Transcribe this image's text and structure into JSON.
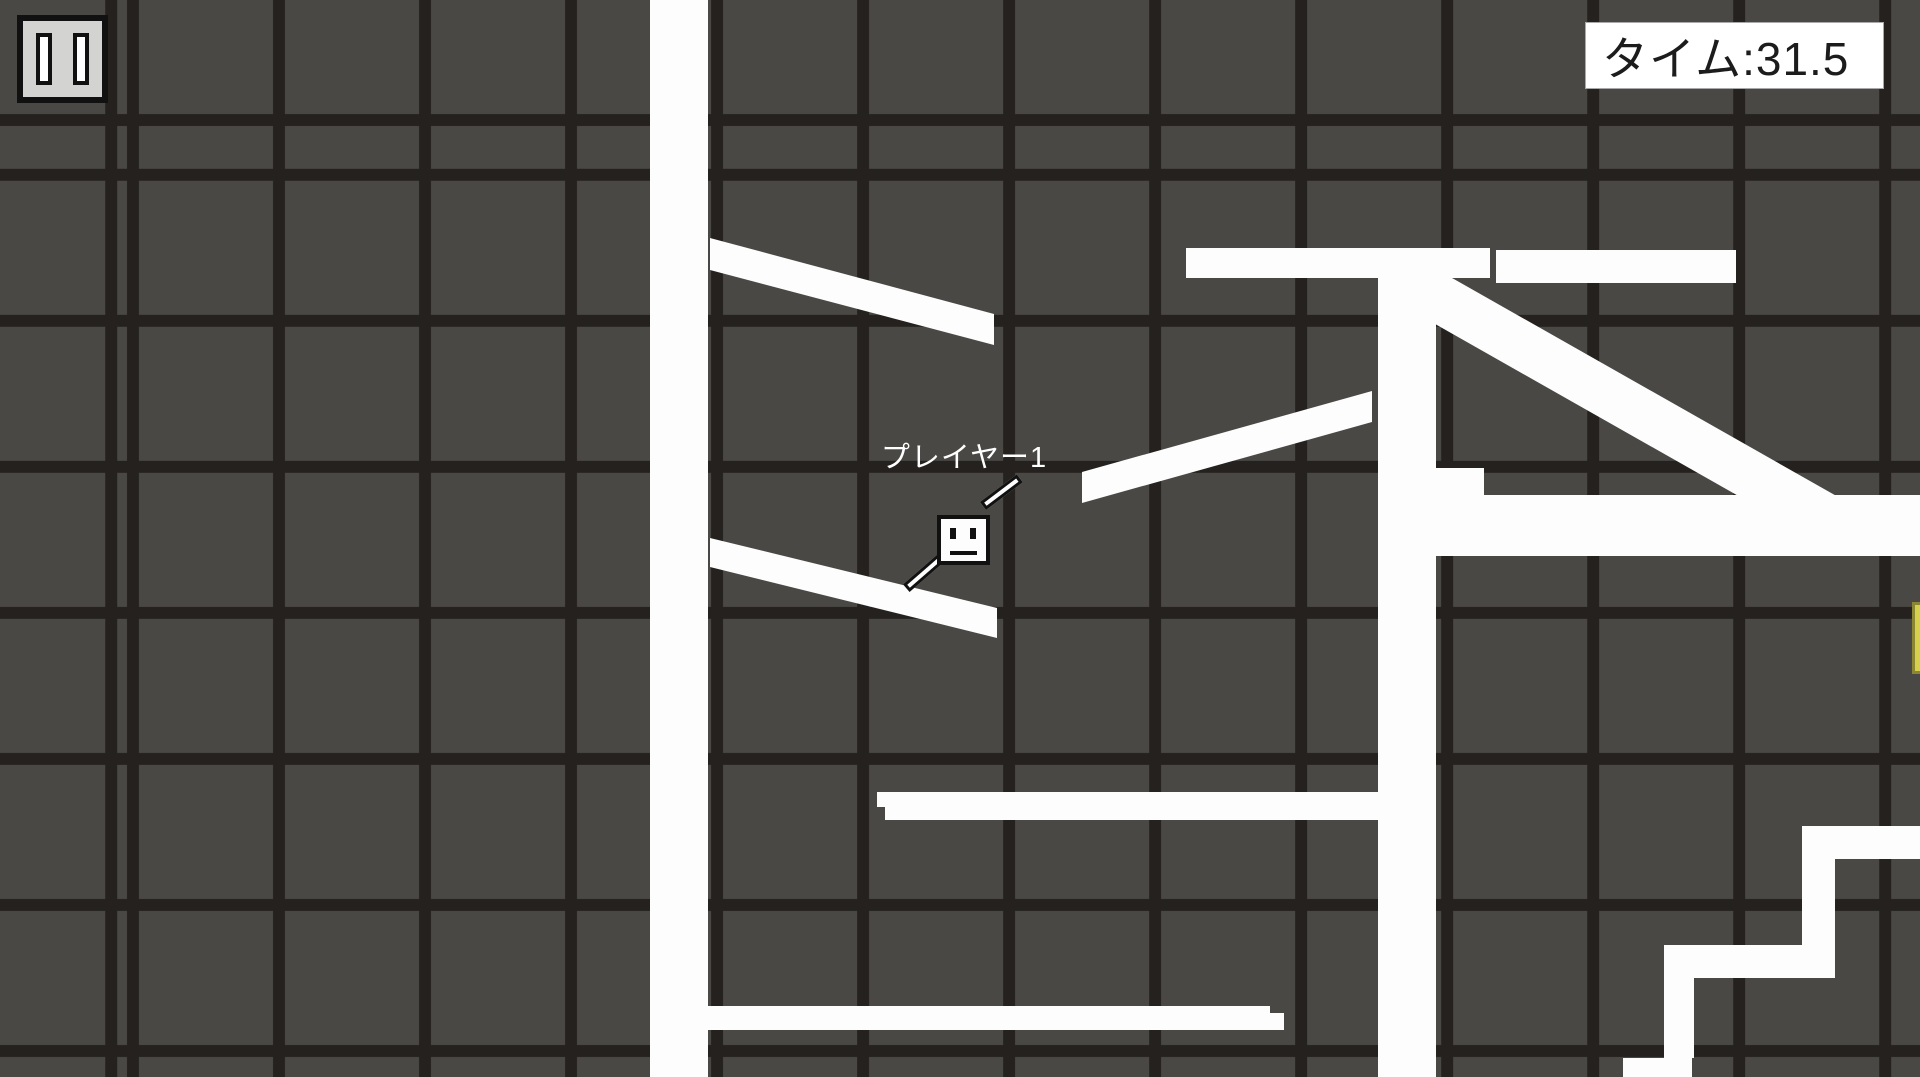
{
  "hud": {
    "pause": {
      "icon": "pause-icon"
    },
    "timer": {
      "label": "タイム:31.5"
    }
  },
  "player": {
    "name_label": "プレイヤー1",
    "x": 937,
    "y": 515
  },
  "colors": {
    "background": "#4a4845",
    "grid_line": "#24211e",
    "platform": "#fdfdfd",
    "goal": "#d5d14b",
    "goal_border": "#8a8631",
    "hud_panel": "#ffffff",
    "hud_text": "#1c1c1c",
    "pause_fill": "#d3d3d1"
  },
  "level": {
    "platforms": [
      {
        "name": "left-column",
        "x": 650,
        "y": 0,
        "w": 58,
        "h": 1077
      },
      {
        "name": "top-bar-left",
        "x": 1186,
        "y": 248,
        "w": 304,
        "h": 30
      },
      {
        "name": "top-bar-right",
        "x": 1496,
        "y": 250,
        "w": 240,
        "h": 33
      },
      {
        "name": "right-column",
        "x": 1378,
        "y": 250,
        "w": 58,
        "h": 827
      },
      {
        "name": "right-band",
        "x": 1436,
        "y": 495,
        "w": 484,
        "h": 61
      },
      {
        "name": "right-band-step",
        "x": 1436,
        "y": 468,
        "w": 48,
        "h": 28
      },
      {
        "name": "mid-bar",
        "x": 885,
        "y": 792,
        "w": 493,
        "h": 28
      },
      {
        "name": "mid-bar-step",
        "x": 877,
        "y": 792,
        "w": 11,
        "h": 15
      },
      {
        "name": "bottom-bar",
        "x": 708,
        "y": 1006,
        "w": 562,
        "h": 24
      },
      {
        "name": "bottom-bar-step",
        "x": 1268,
        "y": 1013,
        "w": 16,
        "h": 17
      },
      {
        "name": "stair-top-tread",
        "x": 1802,
        "y": 826,
        "w": 118,
        "h": 33
      },
      {
        "name": "stair-riser-1",
        "x": 1802,
        "y": 826,
        "w": 33,
        "h": 152
      },
      {
        "name": "stair-mid-tread",
        "x": 1692,
        "y": 945,
        "w": 143,
        "h": 33
      },
      {
        "name": "stair-riser-2",
        "x": 1664,
        "y": 945,
        "w": 30,
        "h": 113
      },
      {
        "name": "stair-low-tread",
        "x": 1623,
        "y": 1058,
        "w": 69,
        "h": 19
      }
    ],
    "ramps": [
      {
        "name": "ramp-upper-left",
        "points": "710,238 994,314 994,345 710,270"
      },
      {
        "name": "ramp-lower-left",
        "points": "710,538 997,608 997,638 710,567"
      },
      {
        "name": "ramp-middle",
        "points": "1082,472 1372,391 1372,422 1082,503"
      },
      {
        "name": "ramp-right",
        "points": "1438,270 1840,498 1816,540 1414,312"
      }
    ],
    "goal": {
      "name": "goal-item",
      "x": 1912,
      "y": 602,
      "w": 8,
      "h": 72
    }
  }
}
